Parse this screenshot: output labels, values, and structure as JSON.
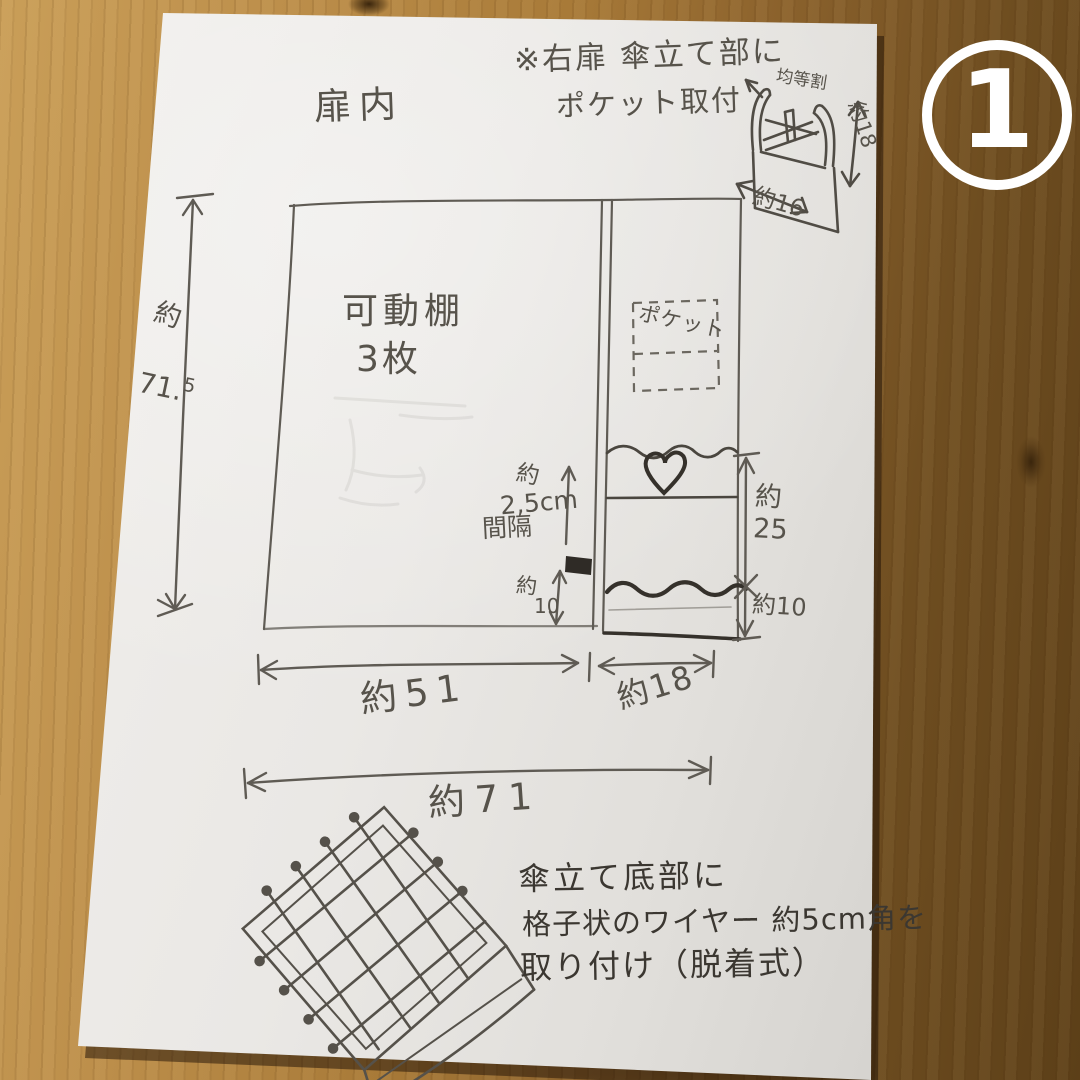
{
  "badge": {
    "number": "1"
  },
  "sketch": {
    "area_label": "扉内",
    "top_note": {
      "line1": "※右扉 傘立て部に",
      "line2": "ポケット取付"
    },
    "door_pocket_box": {
      "label": "均等割",
      "height": "約18",
      "width": "約16"
    },
    "cabinet": {
      "shelf_note_line1": "可動棚",
      "shelf_note_line2": "3枚",
      "pocket_label": "ポケット",
      "gap_note": {
        "line1": "約",
        "line2": "2,5cm",
        "line3": "間隔"
      },
      "divider_bottom": {
        "prefix": "約",
        "value": "10"
      },
      "right_upper": "約\n25",
      "right_lower": "約10",
      "height": {
        "prefix": "約",
        "value": "71.",
        "sup": "5"
      },
      "width_left": "約51",
      "width_right": "約18",
      "width_total": "約71"
    },
    "bottom_note": {
      "line1": "傘立て底部に",
      "line2": "格子状のワイヤー 約5cm角を",
      "line3": "取り付け（脱着式）"
    }
  }
}
